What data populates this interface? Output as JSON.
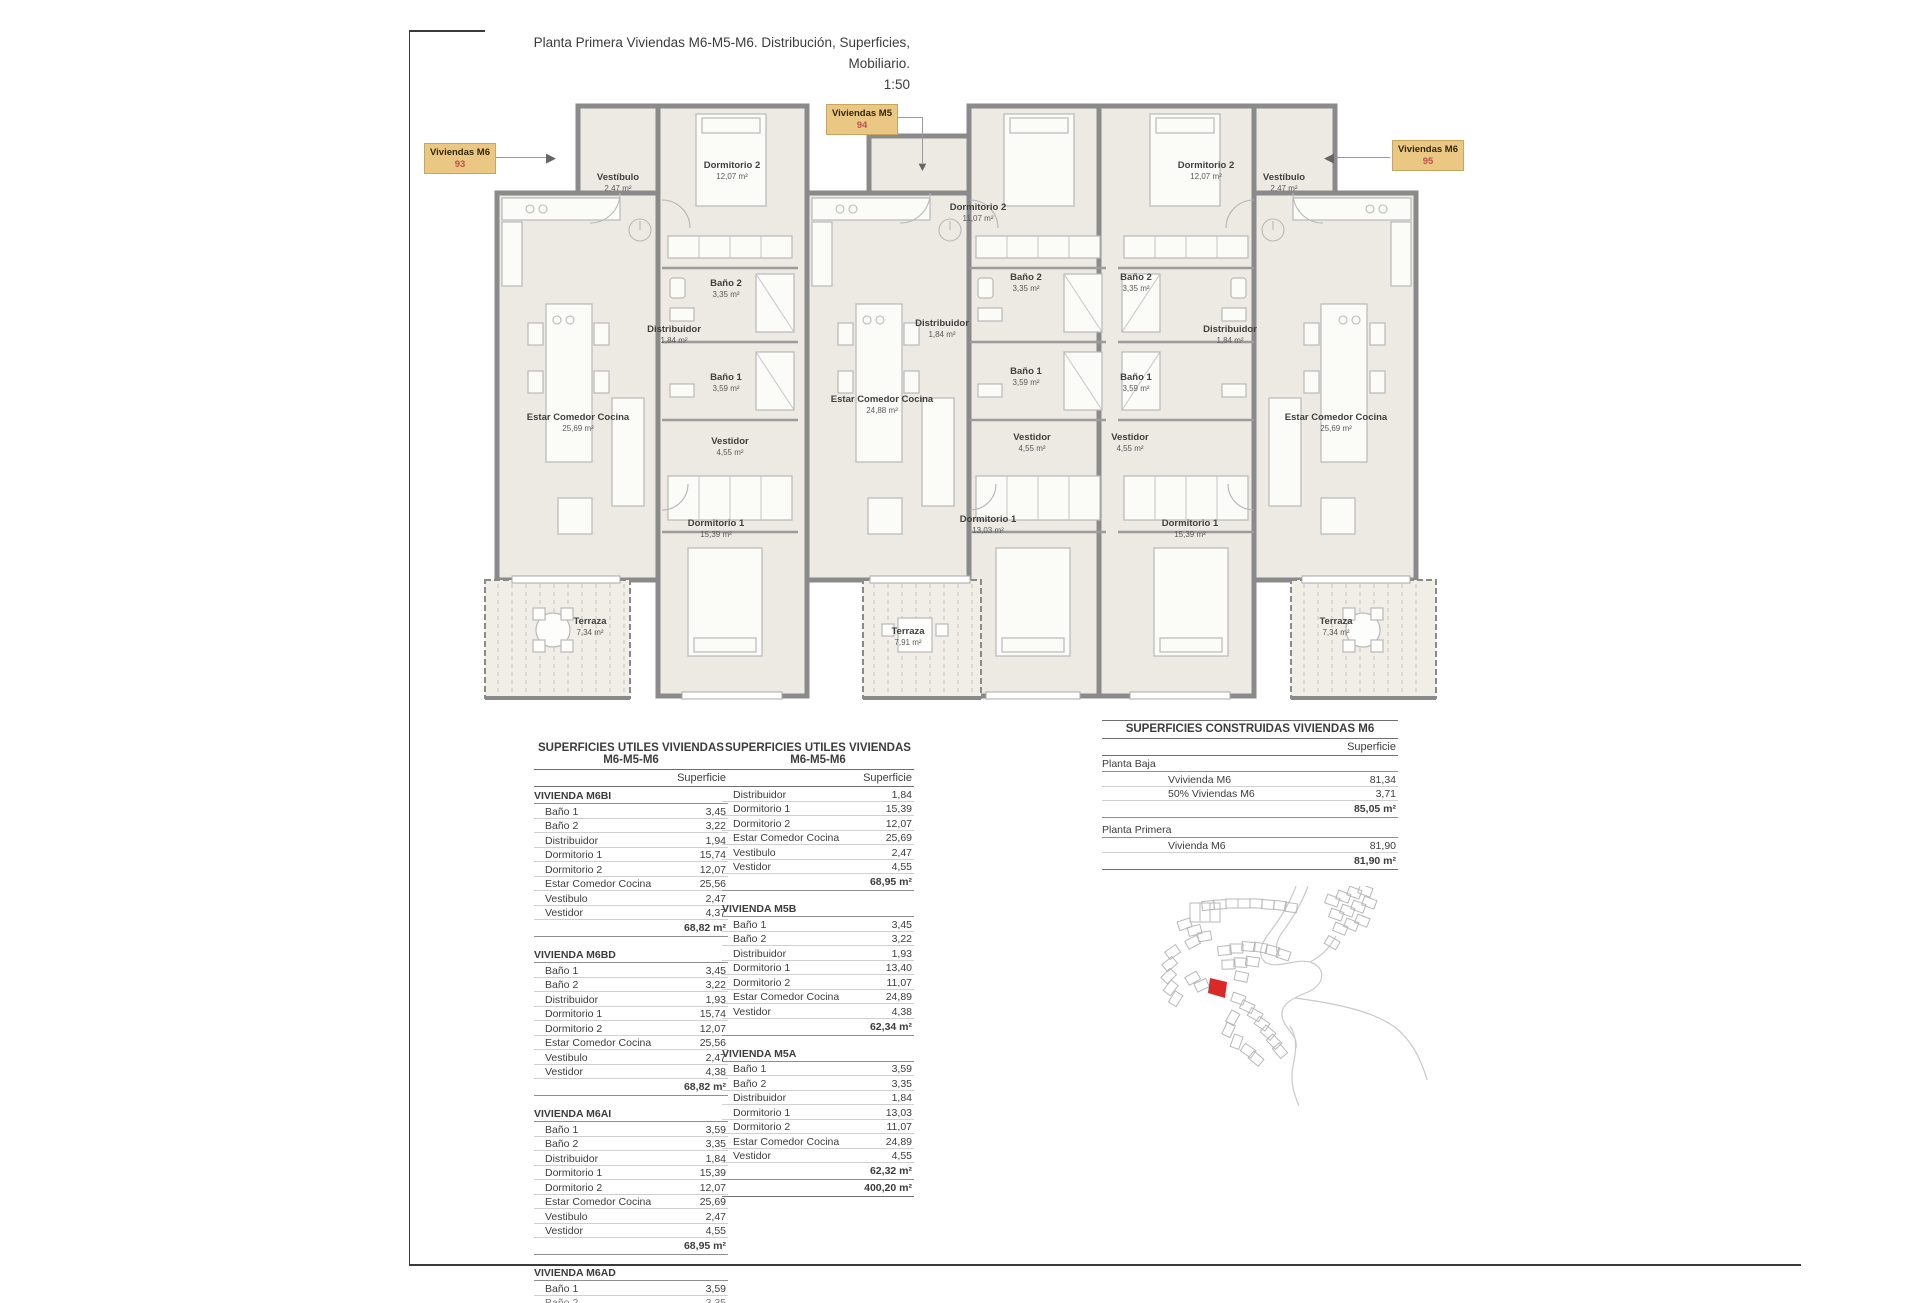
{
  "sheet": {
    "title": "Planta Primera Viviendas M6-M5-M6. Distribución, Superficies, Mobiliario.",
    "scale": "1:50"
  },
  "colors": {
    "unit_tag_bg": "#EAC883",
    "unit_number_red": "#C0504D",
    "map_highlight_red": "#DA2A27",
    "wall_gray": "#8A8A8A",
    "floor_beige": "#EDEAE3"
  },
  "plan": {
    "unit_labels": [
      {
        "name": "Viviendas M6",
        "number": "93"
      },
      {
        "name": "Viviendas M5",
        "number": "94"
      },
      {
        "name": "Viviendas M6",
        "number": "95"
      }
    ],
    "rooms": [
      {
        "label": "Vestíbulo",
        "area": "2,47 m²"
      },
      {
        "label": "Dormitorio 2",
        "area": "12,07 m²"
      },
      {
        "label": "Baño 2",
        "area": "3,35 m²"
      },
      {
        "label": "Distribuidor",
        "area": "1,84 m²"
      },
      {
        "label": "Baño 1",
        "area": "3,59 m²"
      },
      {
        "label": "Vestidor",
        "area": "4,55 m²"
      },
      {
        "label": "Estar Comedor Cocina",
        "area": "25,69 m²"
      },
      {
        "label": "Dormitorio 1",
        "area": "15,39 m²"
      },
      {
        "label": "Terraza",
        "area": "7,34 m²"
      },
      {
        "label": "Dormitorio 2",
        "area": "11,07 m²"
      },
      {
        "label": "Baño 2",
        "area": "3,35 m²"
      },
      {
        "label": "Distribuidor",
        "area": "1,84 m²"
      },
      {
        "label": "Baño 1",
        "area": "3,59 m²"
      },
      {
        "label": "Vestidor",
        "area": "4,55 m²"
      },
      {
        "label": "Estar Comedor Cocina",
        "area": "24,88 m²"
      },
      {
        "label": "Dormitorio 1",
        "area": "13,03 m²"
      },
      {
        "label": "Terraza",
        "area": "7,91 m²"
      },
      {
        "label": "Dormitorio 2",
        "area": "12,07 m²"
      },
      {
        "label": "Vestíbulo",
        "area": "2,47 m²"
      },
      {
        "label": "Baño 2",
        "area": "3,35 m²"
      },
      {
        "label": "Distribuidor",
        "area": "1,84 m²"
      },
      {
        "label": "Baño 1",
        "area": "3,59 m²"
      },
      {
        "label": "Vestidor",
        "area": "4,55 m²"
      },
      {
        "label": "Dormitorio 1",
        "area": "15,39 m²"
      },
      {
        "label": "Estar Comedor Cocina",
        "area": "25,69 m²"
      },
      {
        "label": "Terraza",
        "area": "7,34 m²"
      }
    ]
  },
  "tables": {
    "utiles1": {
      "title_line1": "SUPERFICIES UTILES VIVIENDAS",
      "title_line2": "M6-M5-M6",
      "col_header": "Superficie",
      "sections": [
        {
          "name": "VIVIENDA M6BI",
          "total": "68,82 m²",
          "rows": [
            {
              "label": "Baño 1",
              "value": "3,45"
            },
            {
              "label": "Baño 2",
              "value": "3,22"
            },
            {
              "label": "Distribuidor",
              "value": "1,94"
            },
            {
              "label": "Dormitorio 1",
              "value": "15,74"
            },
            {
              "label": "Dormitorio 2",
              "value": "12,07"
            },
            {
              "label": "Estar Comedor Cocina",
              "value": "25,56"
            },
            {
              "label": "Vestibulo",
              "value": "2,47"
            },
            {
              "label": "Vestidor",
              "value": "4,37"
            }
          ]
        },
        {
          "name": "VIVIENDA M6BD",
          "total": "68,82 m²",
          "rows": [
            {
              "label": "Baño 1",
              "value": "3,45"
            },
            {
              "label": "Baño 2",
              "value": "3,22"
            },
            {
              "label": "Distribuidor",
              "value": "1,93"
            },
            {
              "label": "Dormitorio 1",
              "value": "15,74"
            },
            {
              "label": "Dormitorio 2",
              "value": "12,07"
            },
            {
              "label": "Estar Comedor Cocina",
              "value": "25,56"
            },
            {
              "label": "Vestibulo",
              "value": "2,47"
            },
            {
              "label": "Vestidor",
              "value": "4,38"
            }
          ]
        },
        {
          "name": "VIVIENDA M6AI",
          "total": "68,95 m²",
          "rows": [
            {
              "label": "Baño 1",
              "value": "3,59"
            },
            {
              "label": "Baño 2",
              "value": "3,35"
            },
            {
              "label": "Distribuidor",
              "value": "1,84"
            },
            {
              "label": "Dormitorio 1",
              "value": "15,39"
            },
            {
              "label": "Dormitorio 2",
              "value": "12,07"
            },
            {
              "label": "Estar Comedor Cocina",
              "value": "25,69"
            },
            {
              "label": "Vestibulo",
              "value": "2,47"
            },
            {
              "label": "Vestidor",
              "value": "4,55"
            }
          ]
        },
        {
          "name": "VIVIENDA M6AD",
          "rows": [
            {
              "label": "Baño 1",
              "value": "3,59"
            }
          ],
          "partial": {
            "label": "Baño 2",
            "value": "3,35"
          }
        }
      ]
    },
    "utiles2": {
      "title_line1": "SUPERFICIES UTILES VIVIENDAS",
      "title_line2": "M6-M5-M6",
      "col_header": "Superficie",
      "cont": {
        "total": "68,95 m²",
        "rows": [
          {
            "label": "Distribuidor",
            "value": "1,84"
          },
          {
            "label": "Dormitorio 1",
            "value": "15,39"
          },
          {
            "label": "Dormitorio 2",
            "value": "12,07"
          },
          {
            "label": "Estar Comedor Cocina",
            "value": "25,69"
          },
          {
            "label": "Vestibulo",
            "value": "2,47"
          },
          {
            "label": "Vestidor",
            "value": "4,55"
          }
        ]
      },
      "sections": [
        {
          "name": "VIVIENDA M5B",
          "total": "62,34 m²",
          "rows": [
            {
              "label": "Baño 1",
              "value": "3,45"
            },
            {
              "label": "Baño 2",
              "value": "3,22"
            },
            {
              "label": "Distribuidor",
              "value": "1,93"
            },
            {
              "label": "Dormitorio 1",
              "value": "13,40"
            },
            {
              "label": "Dormitorio 2",
              "value": "11,07"
            },
            {
              "label": "Estar Comedor Cocina",
              "value": "24,89"
            },
            {
              "label": "Vestidor",
              "value": "4,38"
            }
          ]
        },
        {
          "name": "VIVIENDA M5A",
          "total": "62,32 m²",
          "rows": [
            {
              "label": "Baño 1",
              "value": "3,59"
            },
            {
              "label": "Baño 2",
              "value": "3,35"
            },
            {
              "label": "Distribuidor",
              "value": "1,84"
            },
            {
              "label": "Dormitorio 1",
              "value": "13,03"
            },
            {
              "label": "Dormitorio 2",
              "value": "11,07"
            },
            {
              "label": "Estar Comedor Cocina",
              "value": "24,89"
            },
            {
              "label": "Vestidor",
              "value": "4,55"
            }
          ]
        }
      ],
      "grand_total": "400,20 m²"
    },
    "construidas": {
      "title": "SUPERFICIES CONSTRUIDAS VIVIENDAS M6",
      "col_header": "Superficie",
      "groups": [
        {
          "name": "Planta Baja",
          "total": "85,05 m²",
          "rows": [
            {
              "label": "Vvivienda M6",
              "value": "81,34"
            },
            {
              "label": "50% Viviendas M6",
              "value": "3,71"
            }
          ]
        },
        {
          "name": "Planta Primera",
          "total": "81,90 m²",
          "rows": [
            {
              "label": "Vivienda M6",
              "value": "81,90"
            }
          ]
        }
      ]
    }
  }
}
